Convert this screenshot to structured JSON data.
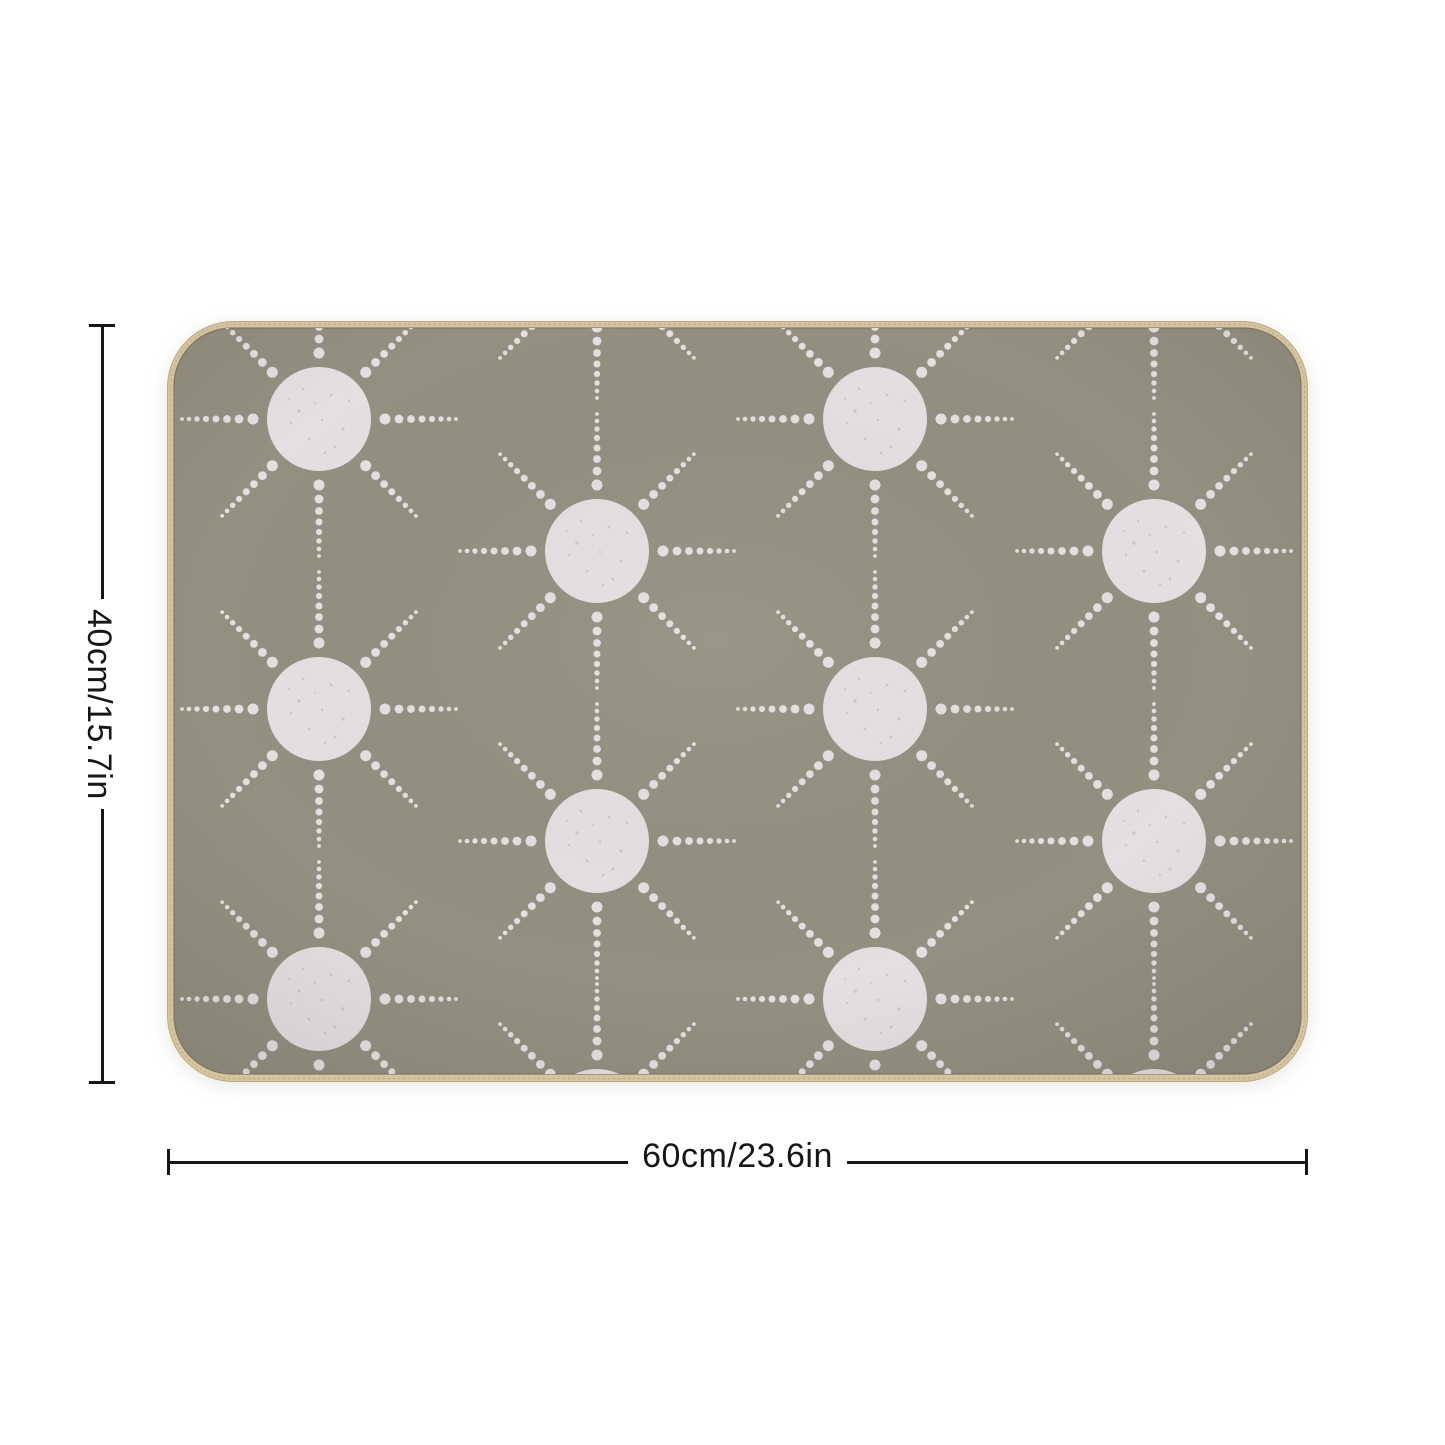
{
  "figure": {
    "type": "product-dimension-illustration",
    "background_color": "#ffffff"
  },
  "mat": {
    "shape": "rounded-rectangle",
    "ground_color": "#949081",
    "sun_color": "#e5dfe1",
    "binding_color": "#d5c49d",
    "binding_stitch_color": "#bcaa82",
    "seam_color": "#7e796c",
    "pattern": {
      "motif": "dotted-sun",
      "circle_radius": 52,
      "ray_count": 8,
      "base_dot_distance": 66,
      "base_dot_radius": 5.5,
      "ray_dot_distances": [
        80,
        92,
        103,
        113,
        122,
        130,
        137
      ],
      "ray_dot_radii": [
        4.4,
        3.9,
        3.5,
        3.1,
        2.7,
        2.3,
        1.9
      ],
      "sun_positions": [
        [
          152,
          98
        ],
        [
          152,
          388
        ],
        [
          152,
          678
        ],
        [
          708,
          98
        ],
        [
          708,
          388
        ],
        [
          708,
          678
        ],
        [
          430,
          -60
        ],
        [
          430,
          230
        ],
        [
          430,
          520
        ],
        [
          430,
          800
        ],
        [
          987,
          -60
        ],
        [
          987,
          230
        ],
        [
          987,
          520
        ],
        [
          987,
          800
        ]
      ]
    }
  },
  "dimensions": {
    "height_label": "40cm/15.7in",
    "width_label": "60cm/23.6in",
    "line_color": "#161616"
  }
}
